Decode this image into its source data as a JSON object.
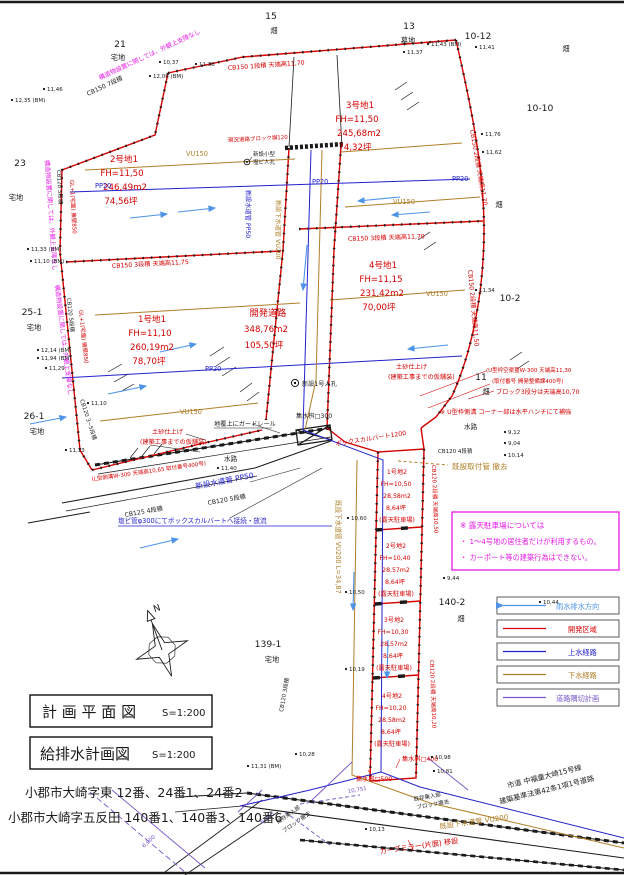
{
  "colors": {
    "boundary_red": "#d40000",
    "note_magenta": "#e81ae8",
    "water_blue": "#2222cc",
    "rain_lightblue": "#4d94e8",
    "sewer_brown": "#b07f28",
    "corner_purple": "#7755cc"
  },
  "titles": [
    {
      "label": "計 画 平 面 図",
      "scale": "S=1:200"
    },
    {
      "label": "給排水計画図",
      "scale": "S=1:200"
    }
  ],
  "addresses": [
    "小郡市大崎字東  12番、24番1、24番2",
    "小郡市大崎字五反田  140番1、140番3、140番6"
  ],
  "note": {
    "line1": "※  露天駐車場については",
    "line2": "・  1〜4号地の居住者だけが利用するもの。",
    "line3": "・  カーポート等の建築行為はできない。"
  },
  "legend": {
    "items": [
      {
        "label": "雨水排水方向"
      },
      {
        "label": "開発区域"
      },
      {
        "label": "上水経路"
      },
      {
        "label": "下水経路"
      },
      {
        "label": "道路隅切計画"
      }
    ]
  },
  "lots": [
    {
      "name": "1号地1",
      "fh": "FH=11,10",
      "area": "260,19m2",
      "tsubo": "78,70坪"
    },
    {
      "name": "2号地1",
      "fh": "FH=11,50",
      "area": "246,49m2",
      "tsubo": "74,56坪"
    },
    {
      "name": "3号地1",
      "fh": "FH=11,50",
      "area": "245,68m2",
      "tsubo": "74,32坪"
    },
    {
      "name": "4号地1",
      "fh": "FH=11,15",
      "area": "231,42m2",
      "tsubo": "70,00坪"
    }
  ],
  "road": {
    "name": "開発道路",
    "area": "348,76m2",
    "tsubo": "105,50坪"
  },
  "stalls": [
    {
      "name": "1号地2",
      "fh": "FH=10,50",
      "area": "28,58m2",
      "tsubo": "8,64坪",
      "use": "(露天駐車場)"
    },
    {
      "name": "2号地2",
      "fh": "FH=10,40",
      "area": "28,57m2",
      "tsubo": "8,64坪",
      "use": "(露天駐車場)"
    },
    {
      "name": "3号地2",
      "fh": "FH=10,30",
      "area": "28,57m2",
      "tsubo": "8,64坪",
      "use": "(露天駐車場)"
    },
    {
      "name": "4号地2",
      "fh": "FH=10,20",
      "area": "28,58m2",
      "tsubo": "8,64坪",
      "use": "(露天駐車場)"
    }
  ],
  "parcels": [
    {
      "num": "21",
      "use": "宅地"
    },
    {
      "num": "15",
      "use": "畑"
    },
    {
      "num": "13",
      "use": "墓地"
    },
    {
      "num": "10-12",
      "use": "畑"
    },
    {
      "num": "10-10",
      "use": "畑"
    },
    {
      "num": "10-2",
      "use": ""
    },
    {
      "num": "11",
      "use": "畑"
    },
    {
      "num": "23",
      "use": "宅地"
    },
    {
      "num": "25-1",
      "use": "宅地"
    },
    {
      "num": "26-1",
      "use": "宅地"
    },
    {
      "num": "139-1",
      "use": "宅地"
    },
    {
      "num": "140-2",
      "use": "畑"
    }
  ],
  "pipes": {
    "vu150": "VU150",
    "pp20": "PP20",
    "pp50": "新設水道管 PP50",
    "road_sewer": "新設下水道管 VU200",
    "road_water": "新設水道管 PP50",
    "vu200_v": "既設下水道管 VU200 L=34,87",
    "vu200_b": "既設下水道管 VU200"
  },
  "ann": {
    "cb150_1dan": "CB150 1段積 天端高11,70",
    "cb150_3dan_1175": "CB150 3段積 天端高11,75",
    "cb150_3dan_1170": "CB150 3段積 天端高11,70",
    "cb150_2dan_1170": "CB150 2段積 天端高11,70",
    "cb150_2dan_1150": "CB150 2段積 天端高11,50",
    "cb150_7dan": "CB150 7段積",
    "cb120_5dan": "CB120 5段積",
    "cb120_35dan": "CB120 3~5段積",
    "cb125_4dan": "CB125 4段積",
    "cb120_4dan": "CB120 4段積",
    "cb120_3dan": "CB120 3段積",
    "cb120_2dan_a": "CB120 2段積 天端高10,50",
    "cb120_2dan_b": "CB120 2段積 天端高10,20",
    "gaikan": "構造物設置に関しては、外観上支障なし",
    "gl_kabe": "GL+1(宅盤) 擁壁850",
    "genkyo_block": "現況道路ブロック塀120",
    "dosha1": "土砂仕上げ",
    "dosha2": "(建築工事までの仮舗装)",
    "utype_l1": "(U型枠空渠蓋W-300 天端高11,30",
    "utype_l2": "(取付番号 開発整備課400号)",
    "block3dan": "ブロック3段分は天端高10,70",
    "uhanchi": "※ U型枠側溝 コーナー部は水平ハンチにて補強",
    "ltype": "(L型側溝W-300 天端高10,65 取付番号400号)",
    "guardrail": "地覆上にガードレール",
    "jinko1": "新設1号人孔",
    "jinko_s1": "新設小型",
    "jinko_s2": "塩ビ人孔",
    "box_culvert": "ボックスカルバート1200",
    "enbi": "塩ビ管φ300にてボックスカルバートへ接続・放流",
    "suiro": "水路",
    "shusui300": "集水桝□300",
    "shusui400": "集水桝□400",
    "shusui500": "集水桝□500",
    "kisetsu_toritsuke": "既設取付管  撤去",
    "curve_mirror": "カーブミラー(片面) 移設",
    "shido1": "市道  中福童大崎15号線",
    "shido2": "建築基準法第42条1項1号道路",
    "kison1": "既存乗入部",
    "kison2": "ブロック撤去",
    "dim1": "6,960",
    "dim2": "10,751",
    "dim3": "6,900",
    "north": "N"
  },
  "spots": [
    {
      "t": "12,35 (BM)",
      "x": 12,
      "y": 100
    },
    {
      "t": "11,46",
      "x": 44,
      "y": 89
    },
    {
      "t": "10,37",
      "x": 160,
      "y": 62
    },
    {
      "t": "11,38",
      "x": 196,
      "y": 64
    },
    {
      "t": "12,06 (BM)",
      "x": 150,
      "y": 76
    },
    {
      "t": "11,43 (BM)",
      "x": 428,
      "y": 44
    },
    {
      "t": "11,37",
      "x": 404,
      "y": 52
    },
    {
      "t": "11,41",
      "x": 476,
      "y": 47
    },
    {
      "t": "11,76",
      "x": 482,
      "y": 134
    },
    {
      "t": "11,62",
      "x": 483,
      "y": 152
    },
    {
      "t": "11,34",
      "x": 476,
      "y": 290
    },
    {
      "t": "11,33 (BM)",
      "x": 28,
      "y": 249
    },
    {
      "t": "11,10 (BM)",
      "x": 31,
      "y": 261
    },
    {
      "t": "12,14 (BM)",
      "x": 38,
      "y": 350
    },
    {
      "t": "11,94 (BM)",
      "x": 38,
      "y": 358
    },
    {
      "t": "11,29",
      "x": 46,
      "y": 368
    },
    {
      "t": "11,10",
      "x": 88,
      "y": 403
    },
    {
      "t": "11,13",
      "x": 66,
      "y": 450
    },
    {
      "t": "9,12",
      "x": 505,
      "y": 432
    },
    {
      "t": "9,04",
      "x": 505,
      "y": 443
    },
    {
      "t": "10,14",
      "x": 505,
      "y": 455
    },
    {
      "t": "9,44",
      "x": 444,
      "y": 578
    },
    {
      "t": "10,60",
      "x": 348,
      "y": 518
    },
    {
      "t": "10,50",
      "x": 346,
      "y": 592
    },
    {
      "t": "10,19",
      "x": 346,
      "y": 669
    },
    {
      "t": "10,28",
      "x": 296,
      "y": 754
    },
    {
      "t": "11,31 (BM)",
      "x": 248,
      "y": 766
    },
    {
      "t": "10,98",
      "x": 432,
      "y": 757
    },
    {
      "t": "10,81",
      "x": 434,
      "y": 771
    },
    {
      "t": "10,13",
      "x": 366,
      "y": 829
    },
    {
      "t": "11,40",
      "x": 218,
      "y": 468
    },
    {
      "t": "10,44",
      "x": 540,
      "y": 602
    }
  ]
}
